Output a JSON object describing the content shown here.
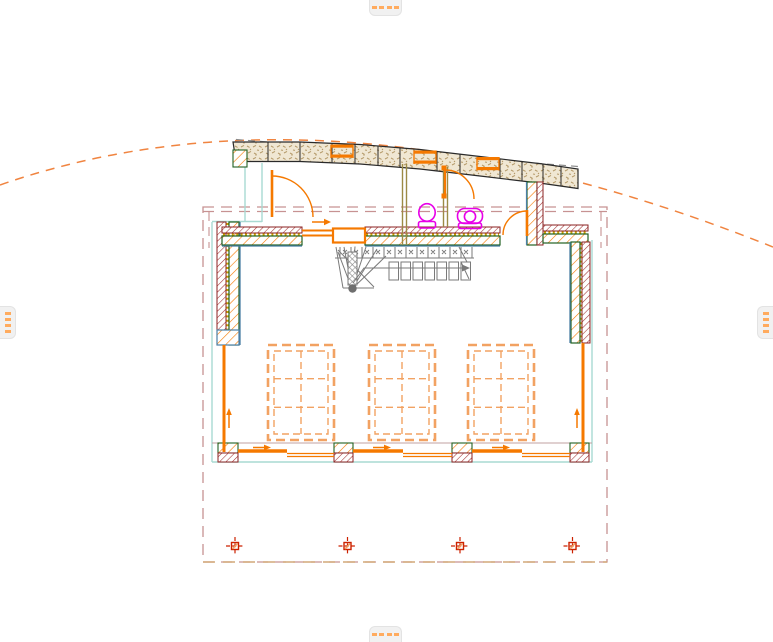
{
  "canvas": {
    "type": "cad-floor-plan-view",
    "background": "#FFFFFF"
  },
  "palette": {
    "accent_orange": "#F57900",
    "light_orange_dash": "#F2A262",
    "roof_arc_orange": "#F08440",
    "wall_maroon": "#8B2222",
    "wall_green": "#226022",
    "inner_face_blue": "#4A7FA5",
    "lower_story_teal": "#A9DAD2",
    "insulation_yellow": "#C8A000",
    "partition_olive": "#9C8A45",
    "roof_band_tan": "#F0E7D3",
    "stair_grey": "#7A7A7A",
    "fixture_magenta": "#E800E8",
    "marquee_rose": "#C79292",
    "grid_marker_red": "#CC2200",
    "handle_bg": "#F1F1F1",
    "handle_dash": "#FFAB5E"
  },
  "scroll_handles": {
    "dash_count": 4,
    "positions": [
      "top",
      "bottom",
      "left",
      "right"
    ]
  },
  "plan_elements": {
    "roof_windows": 3,
    "doors": 3,
    "toilets": 2,
    "floor_openings": 3,
    "grid_markers": 4,
    "window_direction_arrows": 5,
    "stair": "winder-stair-with-straight-run"
  }
}
